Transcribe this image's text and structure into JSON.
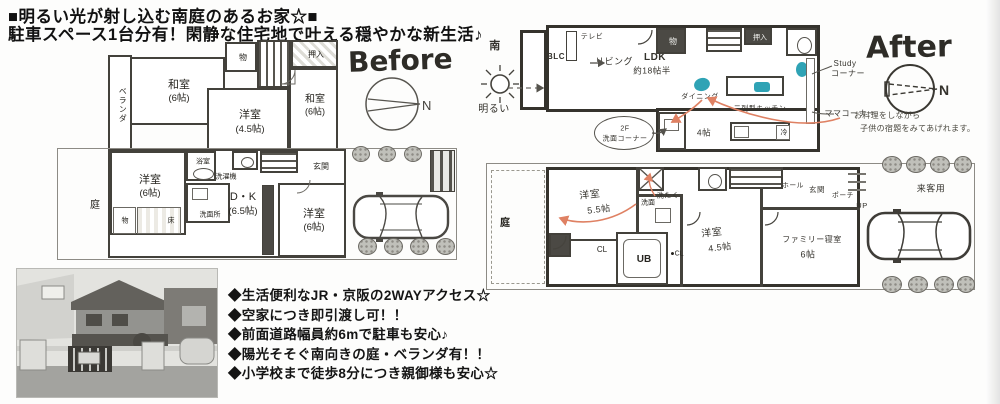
{
  "header": {
    "line1": "■明るい光が射し込む南庭のあるお家☆■",
    "line2": "駐車スペース1台分有！閑静な住宅地で叶える穏やかな新生活♪"
  },
  "before": {
    "title": "Before",
    "compass_n": "N",
    "floor2": {
      "veranda": "ベランダ",
      "washitsu1": "和室",
      "washitsu1_size": "(6帖)",
      "mono": "物",
      "oshiire": "押入",
      "yoshitsu": "洋室",
      "yoshitsu_size": "(4.5帖)",
      "washitsu2": "和室",
      "washitsu2_size": "(6帖)"
    },
    "floor1": {
      "niwa": "庭",
      "yoshitsu1": "洋室",
      "yoshitsu1_size": "(6帖)",
      "yokushitsu": "浴室",
      "sentakuki": "洗濯機",
      "senmenjo": "洗面所",
      "mono": "物",
      "toko": "床",
      "dk": "D・K",
      "dk_size": "(6.5帖)",
      "yoshitsu2": "洋室",
      "yoshitsu2_size": "(6帖)",
      "genkan": "玄関"
    }
  },
  "after": {
    "title": "After",
    "compass_n": "N",
    "sun_south": "南",
    "sun_bright": "明るい",
    "floor2": {
      "blc": "BLC",
      "tv": "テレビ",
      "living": "リビング",
      "ldk": "LDK",
      "ldk_size": "約18帖半",
      "mono": "物",
      "oshiire": "押入",
      "dining": "ダイニング",
      "kitchen": "二列型キッチン",
      "fridge": "冷",
      "study1": "Study",
      "study2": "コーナー",
      "mama": "ママコーナー",
      "senmen_note1": "2F",
      "senmen_note2": "洗面コーナー",
      "four_jo": "4帖"
    },
    "note_line1": "お料理をしながら",
    "note_line2": "子供の宿題をみてあげれます。",
    "floor1": {
      "niwa": "庭",
      "yoshitsu55": "洋室",
      "yoshitsu55_size": "5.5帖",
      "cl1": "CL",
      "sentaku": "洗たく",
      "senmen": "洗面",
      "ub": "UB",
      "cl2": "●CL",
      "yoshitsu45": "洋室",
      "yoshitsu45_size": "4.5帖",
      "family": "ファミリー寝室",
      "family_size": "6帖",
      "hall": "ホール",
      "genkan": "玄関",
      "porch": "ポーチ",
      "up": "UP",
      "visitor": "来客用"
    }
  },
  "bullets": [
    "◆生活便利なJR・京阪の2WAYアクセス☆",
    "◆空家につき即引渡し可！！",
    "◆前面道路幅員約6mで駐車も安心♪",
    "◆陽光そそぐ南向きの庭・ベランダ有！！",
    "◆小学校まで徒歩8分につき親御様も安心☆"
  ],
  "colors": {
    "teal": "#2fa3b5",
    "arrow": "#e08060",
    "ink": "#35332d"
  }
}
